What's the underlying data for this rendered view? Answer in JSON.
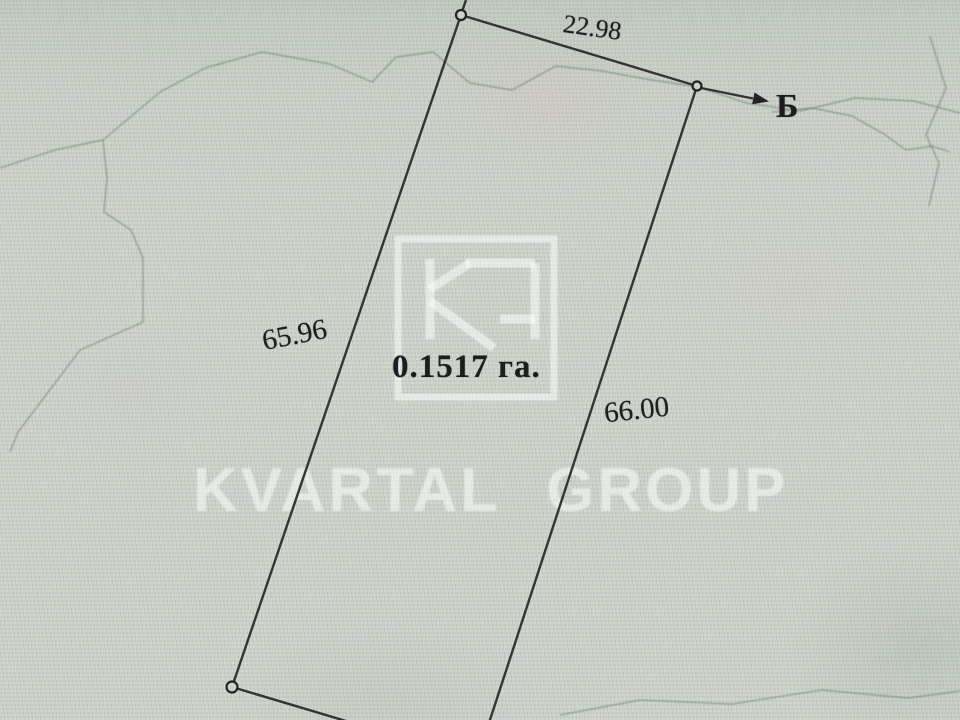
{
  "parcel": {
    "area_label": "0.1517 га.",
    "dimensions": {
      "top": "22.98",
      "left": "65.96",
      "right": "66.00"
    },
    "direction_label": "Б"
  },
  "watermark": {
    "brand_text": "KVARTAL GROUP",
    "logo_monogram": "KG"
  },
  "colors": {
    "paper": "#cbd1c9",
    "boundary_line": "#2b2b2b",
    "ink": "#1d1d1d",
    "contour_line": "#6e8272",
    "watermark_white": "rgba(255,255,255,0.52)"
  }
}
